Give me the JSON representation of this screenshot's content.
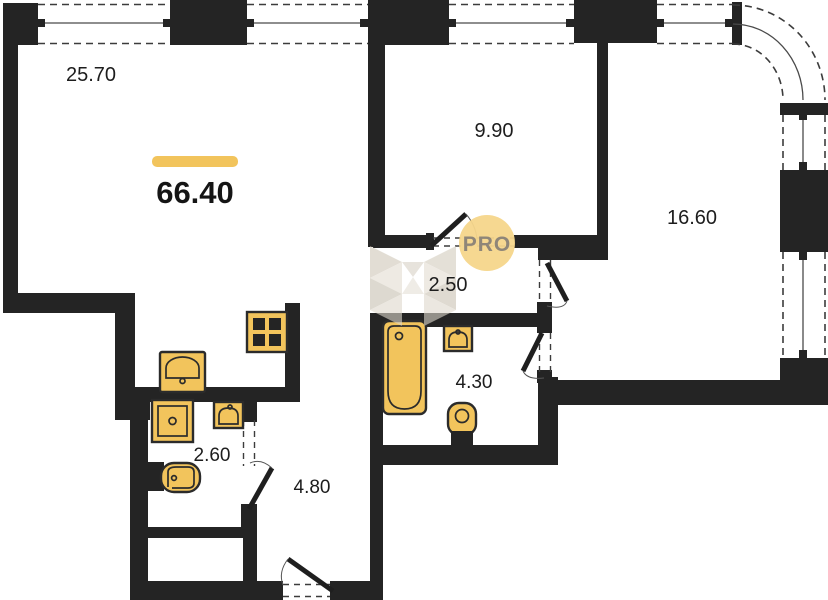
{
  "plan": {
    "title": "apartment-floor-plan",
    "total_area": "66.40",
    "badge": {
      "label": "PRO"
    },
    "rooms": [
      {
        "name": "living-room",
        "area": "25.70"
      },
      {
        "name": "bedroom-small",
        "area": "9.90"
      },
      {
        "name": "bedroom-large",
        "area": "16.60"
      },
      {
        "name": "corridor",
        "area": "2.50"
      },
      {
        "name": "bathroom",
        "area": "4.30"
      },
      {
        "name": "wc",
        "area": "2.60"
      },
      {
        "name": "hallway",
        "area": "4.80"
      }
    ],
    "fixtures": [
      "stove-icon",
      "kitchen-sink-icon",
      "washing-machine-icon",
      "wc-sink-icon",
      "wc-toilet-icon",
      "bathtub-icon",
      "bathroom-sink-icon",
      "bathroom-toilet-icon"
    ],
    "colors": {
      "wall": "#242424",
      "fixture_fill": "#f2c45c",
      "accent_bar": "#f2c45c",
      "badge_bg": "#f5d68b",
      "badge_text": "#8f8678",
      "watermark": "#d8d1c4"
    }
  }
}
